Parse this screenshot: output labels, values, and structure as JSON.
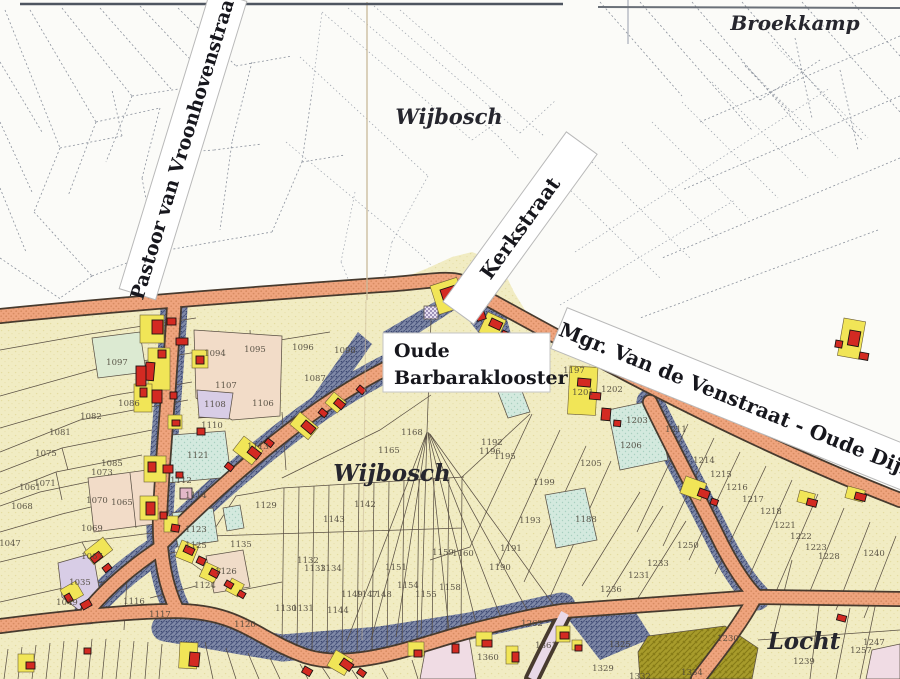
{
  "map": {
    "place_labels": {
      "wijbosch_north": "Wijbosch",
      "broekkamp": "Broekkamp",
      "wijbosch_village": "Wijbosch",
      "locht": "Locht"
    },
    "street_banners": {
      "pastoor": "Pastoor van Vroonhovenstraat",
      "kerkstraat": "Kerkstraat",
      "mgr": "Mgr. Van de Venstraat - Oude Dijk"
    },
    "building_label": {
      "line1": "Oude",
      "line2": "Barbaraklooster"
    },
    "colors": {
      "paper": "#fbfbf8",
      "field": "#f1ecc3",
      "road": "#efa47e",
      "road_casing": "#473a2e",
      "built_strip": "#7e88a6",
      "building_red": "#d32a22",
      "yard_yellow": "#f1e557",
      "light_blue": "#d3e9de",
      "purple": "#d8cde6",
      "pink": "#f2dcc8",
      "olive": "#a79b2b",
      "lavender_road": "#e9d9e8",
      "parcel_line": "#5a5044",
      "number_text": "#4c463a"
    },
    "parcel_numbers": [
      {
        "n": "1097",
        "x": 117,
        "y": 362
      },
      {
        "n": "1094",
        "x": 215,
        "y": 353
      },
      {
        "n": "1095",
        "x": 255,
        "y": 349
      },
      {
        "n": "1096",
        "x": 303,
        "y": 347
      },
      {
        "n": "1098",
        "x": 345,
        "y": 350
      },
      {
        "n": "1087",
        "x": 315,
        "y": 378
      },
      {
        "n": "1086",
        "x": 129,
        "y": 403
      },
      {
        "n": "1107",
        "x": 226,
        "y": 385
      },
      {
        "n": "1106",
        "x": 263,
        "y": 403
      },
      {
        "n": "1108",
        "x": 215,
        "y": 404
      },
      {
        "n": "1110",
        "x": 212,
        "y": 425
      },
      {
        "n": "1121",
        "x": 198,
        "y": 455
      },
      {
        "n": "1112",
        "x": 181,
        "y": 480
      },
      {
        "n": "1114",
        "x": 196,
        "y": 495
      },
      {
        "n": "1113",
        "x": 258,
        "y": 446
      },
      {
        "n": "1082",
        "x": 91,
        "y": 416
      },
      {
        "n": "1081",
        "x": 60,
        "y": 432
      },
      {
        "n": "1075",
        "x": 46,
        "y": 453
      },
      {
        "n": "1071",
        "x": 45,
        "y": 483
      },
      {
        "n": "1061",
        "x": 30,
        "y": 487
      },
      {
        "n": "1068",
        "x": 22,
        "y": 506
      },
      {
        "n": "1070",
        "x": 97,
        "y": 500
      },
      {
        "n": "1065",
        "x": 122,
        "y": 502
      },
      {
        "n": "1069",
        "x": 92,
        "y": 528
      },
      {
        "n": "1047",
        "x": 10,
        "y": 543
      },
      {
        "n": "1067",
        "x": 92,
        "y": 556
      },
      {
        "n": "1085",
        "x": 112,
        "y": 463
      },
      {
        "n": "1073",
        "x": 102,
        "y": 472
      },
      {
        "n": "1035",
        "x": 80,
        "y": 582
      },
      {
        "n": "1049",
        "x": 67,
        "y": 602
      },
      {
        "n": "1116",
        "x": 134,
        "y": 601
      },
      {
        "n": "1117",
        "x": 160,
        "y": 614
      },
      {
        "n": "1120",
        "x": 245,
        "y": 624
      },
      {
        "n": "1126",
        "x": 226,
        "y": 571
      },
      {
        "n": "1124",
        "x": 205,
        "y": 585
      },
      {
        "n": "1123",
        "x": 196,
        "y": 529
      },
      {
        "n": "1125",
        "x": 196,
        "y": 545
      },
      {
        "n": "1135",
        "x": 241,
        "y": 544
      },
      {
        "n": "1129",
        "x": 266,
        "y": 505
      },
      {
        "n": "1130",
        "x": 286,
        "y": 608
      },
      {
        "n": "1131",
        "x": 303,
        "y": 608
      },
      {
        "n": "1144",
        "x": 338,
        "y": 610
      },
      {
        "n": "1142",
        "x": 365,
        "y": 504
      },
      {
        "n": "1143",
        "x": 334,
        "y": 519
      },
      {
        "n": "1151",
        "x": 396,
        "y": 567
      },
      {
        "n": "1149",
        "x": 352,
        "y": 594
      },
      {
        "n": "1147",
        "x": 367,
        "y": 594
      },
      {
        "n": "1148",
        "x": 381,
        "y": 594
      },
      {
        "n": "1154",
        "x": 408,
        "y": 585
      },
      {
        "n": "1155",
        "x": 426,
        "y": 594
      },
      {
        "n": "1158",
        "x": 450,
        "y": 587
      },
      {
        "n": "1159",
        "x": 443,
        "y": 552
      },
      {
        "n": "1160",
        "x": 463,
        "y": 553
      },
      {
        "n": "1165",
        "x": 389,
        "y": 450
      },
      {
        "n": "1168",
        "x": 412,
        "y": 432
      },
      {
        "n": "1163",
        "x": 438,
        "y": 370
      },
      {
        "n": "1132",
        "x": 308,
        "y": 560
      },
      {
        "n": "1133",
        "x": 315,
        "y": 568
      },
      {
        "n": "1134",
        "x": 331,
        "y": 568
      },
      {
        "n": "1190",
        "x": 500,
        "y": 567
      },
      {
        "n": "1191",
        "x": 511,
        "y": 548
      },
      {
        "n": "1193",
        "x": 530,
        "y": 520
      },
      {
        "n": "1192",
        "x": 492,
        "y": 442
      },
      {
        "n": "1196",
        "x": 490,
        "y": 451
      },
      {
        "n": "1195",
        "x": 505,
        "y": 456
      },
      {
        "n": "1199",
        "x": 544,
        "y": 482
      },
      {
        "n": "1188",
        "x": 586,
        "y": 519
      },
      {
        "n": "1197",
        "x": 574,
        "y": 370
      },
      {
        "n": "1201",
        "x": 583,
        "y": 392
      },
      {
        "n": "1202",
        "x": 612,
        "y": 389
      },
      {
        "n": "1203",
        "x": 637,
        "y": 420
      },
      {
        "n": "1206",
        "x": 631,
        "y": 445
      },
      {
        "n": "1205",
        "x": 591,
        "y": 463
      },
      {
        "n": "1211",
        "x": 676,
        "y": 429
      },
      {
        "n": "1214",
        "x": 704,
        "y": 460
      },
      {
        "n": "1215",
        "x": 721,
        "y": 474
      },
      {
        "n": "1216",
        "x": 737,
        "y": 487
      },
      {
        "n": "1217",
        "x": 753,
        "y": 499
      },
      {
        "n": "1218",
        "x": 771,
        "y": 511
      },
      {
        "n": "1221",
        "x": 785,
        "y": 525
      },
      {
        "n": "1222",
        "x": 801,
        "y": 536
      },
      {
        "n": "1223",
        "x": 816,
        "y": 547
      },
      {
        "n": "1228",
        "x": 829,
        "y": 556
      },
      {
        "n": "1240",
        "x": 874,
        "y": 553
      },
      {
        "n": "1250",
        "x": 688,
        "y": 545
      },
      {
        "n": "1233",
        "x": 658,
        "y": 563
      },
      {
        "n": "1231",
        "x": 639,
        "y": 575
      },
      {
        "n": "1236",
        "x": 611,
        "y": 589
      },
      {
        "n": "1230",
        "x": 728,
        "y": 638
      },
      {
        "n": "1239",
        "x": 804,
        "y": 661
      },
      {
        "n": "1247",
        "x": 874,
        "y": 642
      },
      {
        "n": "1257",
        "x": 861,
        "y": 650
      },
      {
        "n": "1325",
        "x": 620,
        "y": 644
      },
      {
        "n": "1329",
        "x": 603,
        "y": 668
      },
      {
        "n": "1332",
        "x": 640,
        "y": 676
      },
      {
        "n": "1334",
        "x": 692,
        "y": 672
      },
      {
        "n": "1361",
        "x": 546,
        "y": 645
      },
      {
        "n": "1262",
        "x": 532,
        "y": 623
      },
      {
        "n": "1360",
        "x": 488,
        "y": 657
      }
    ]
  }
}
